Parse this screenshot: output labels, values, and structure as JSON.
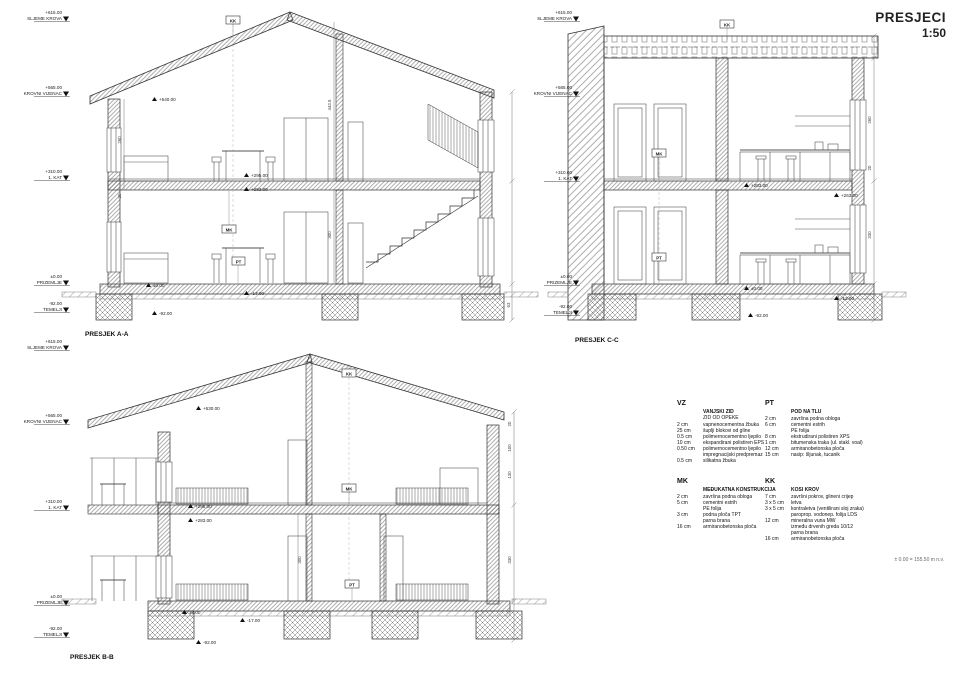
{
  "title": {
    "name": "PRESJECI",
    "scale": "1:50"
  },
  "footnote": "± 0.00 = 155.50 m n.v.",
  "markers": {
    "kk": "KK",
    "mk": "MK",
    "pt": "PT"
  },
  "sections": {
    "aa": {
      "label": "PRESJEK A-A",
      "levels": [
        {
          "elev": "+615.00",
          "name": "SLJEME KROVA"
        },
        {
          "elev": "+565.00",
          "name": "KROVNI VIJENAC"
        },
        {
          "elev": "+310.00",
          "name": "1. KAT"
        },
        {
          "elev": "±0.00",
          "name": "PRIZEMLJE"
        },
        {
          "elev": "-92.00",
          "name": "TEMELJI"
        }
      ],
      "callouts": {
        "c0": "+540.00",
        "c1": "+295.00",
        "c2": "+283.00",
        "c3": "±0.00",
        "c4": "-17.00",
        "c5": "-92.00"
      },
      "dims": [
        "443.5",
        "300",
        "260",
        "20",
        "63"
      ]
    },
    "cc": {
      "label": "PRESJEK C-C",
      "levels": [
        {
          "elev": "+615.00",
          "name": "SLJEME KROVA"
        },
        {
          "elev": "+565.00",
          "name": "KROVNI VIJENAC"
        },
        {
          "elev": "+310.00",
          "name": "1. KAT"
        },
        {
          "elev": "±0.00",
          "name": "PRIZEMLJE"
        },
        {
          "elev": "-92.00",
          "name": "TEMELJI"
        }
      ],
      "callouts": {
        "c0": "+283.00",
        "c1": "+263.00",
        "c2": "±0.00",
        "c3": "-12.00",
        "c4": "-92.00"
      },
      "dims": [
        "260",
        "20",
        "330"
      ]
    },
    "bb": {
      "label": "PRESJEK B-B",
      "levels": [
        {
          "elev": "+615.00",
          "name": "SLJEME KROVA"
        },
        {
          "elev": "+565.00",
          "name": "KROVNI VIJENAC"
        },
        {
          "elev": "+310.00",
          "name": "1. KAT"
        },
        {
          "elev": "±0.00",
          "name": "PRIZEMLJE"
        },
        {
          "elev": "-92.00",
          "name": "TEMELJI"
        }
      ],
      "callouts": {
        "c0": "+630.00",
        "c1": "+295.00",
        "c2": "+283.00",
        "c3": "±0.00",
        "c4": "-17.00",
        "c5": "-92.00"
      },
      "dims": [
        "20",
        "100",
        "130",
        "330",
        "300"
      ]
    }
  },
  "legend": {
    "vz": {
      "code": "VZ",
      "title": "VANJSKI ZID",
      "subtitle": "ZID OD OPEKE",
      "rows": [
        [
          "2 cm",
          "vapnenocementna žbuka"
        ],
        [
          "25 cm",
          "šuplji blokovi od gline"
        ],
        [
          "0.5 cm",
          "polimernocementno ljepilo"
        ],
        [
          "10 cm",
          "ekspandirani polistiren EPS"
        ],
        [
          "0.50 cm",
          "polimernocementno ljepilo"
        ],
        [
          "",
          "impregnacijski predpremaz"
        ],
        [
          "0.5 cm",
          "silikatna žbuka"
        ]
      ]
    },
    "pt": {
      "code": "PT",
      "title": "POD NA TLU",
      "rows": [
        [
          "2 cm",
          "završna podna obloga"
        ],
        [
          "6 cm",
          "cementni estrih"
        ],
        [
          "",
          "PE folija"
        ],
        [
          "8 cm",
          "ekstrudirani polistiren XPS"
        ],
        [
          "1 cm",
          "bitumenska traka (ul. stakl. voal)"
        ],
        [
          "12 cm",
          "armiranobetonska ploča"
        ],
        [
          "15 cm",
          "nasip: šljunak, tucanik"
        ]
      ]
    },
    "mk": {
      "code": "MK",
      "title": "MEĐUKATNA KONSTRUKCIJA",
      "rows": [
        [
          "2 cm",
          "završna podna obloga"
        ],
        [
          "5 cm",
          "cementni estrih"
        ],
        [
          "",
          "PE folija"
        ],
        [
          "3 cm",
          "podna ploča TPT"
        ],
        [
          "",
          "parna brana"
        ],
        [
          "16 cm",
          "armiranobetonska ploča"
        ]
      ]
    },
    "kk": {
      "code": "KK",
      "title": "KOSI KROV",
      "rows": [
        [
          "7 cm",
          "završni pokrov, glineni crijep"
        ],
        [
          "3 x 5 cm",
          "letva"
        ],
        [
          "3 x 5 cm",
          "kontraletva (ventilirani sloj zraka)"
        ],
        [
          "",
          "paroprop. vodonep. folija LDS"
        ],
        [
          "12 cm",
          "mineralna vuna MW"
        ],
        [
          "",
          "između drvenih greda 10/12"
        ],
        [
          "",
          "parna brana"
        ],
        [
          "16 cm",
          "armiranobetonska ploča"
        ]
      ]
    }
  }
}
